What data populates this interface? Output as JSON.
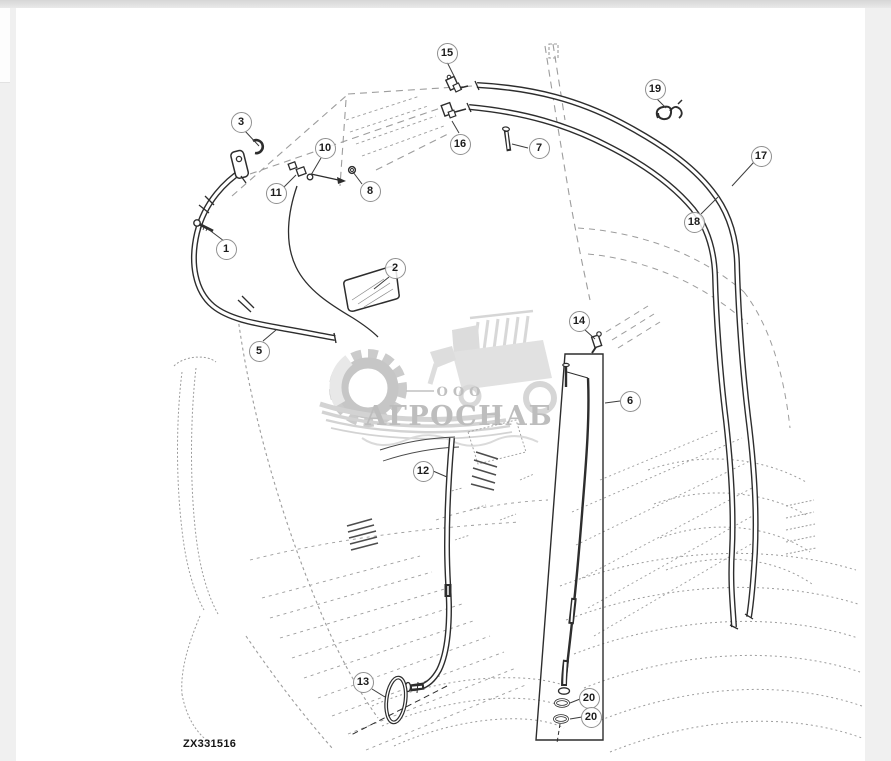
{
  "window": {
    "background_color": "#f0f0f0",
    "topbar_color": "#e2e2e2",
    "panel_color": "#ffffff"
  },
  "diagram": {
    "image_code": "ZX331516",
    "line_color": "#2d2d2d",
    "faint_color": "#9d9d9d",
    "callouts": [
      {
        "label": "1",
        "x": 226,
        "y": 249
      },
      {
        "label": "2",
        "x": 395,
        "y": 268
      },
      {
        "label": "3",
        "x": 241,
        "y": 122
      },
      {
        "label": "5",
        "x": 259,
        "y": 351
      },
      {
        "label": "6",
        "x": 630,
        "y": 401
      },
      {
        "label": "7",
        "x": 539,
        "y": 148
      },
      {
        "label": "8",
        "x": 370,
        "y": 191
      },
      {
        "label": "10",
        "x": 325,
        "y": 148
      },
      {
        "label": "11",
        "x": 276,
        "y": 193
      },
      {
        "label": "12",
        "x": 423,
        "y": 471
      },
      {
        "label": "13",
        "x": 363,
        "y": 682
      },
      {
        "label": "14",
        "x": 579,
        "y": 321
      },
      {
        "label": "15",
        "x": 447,
        "y": 53
      },
      {
        "label": "16",
        "x": 460,
        "y": 144
      },
      {
        "label": "17",
        "x": 761,
        "y": 156
      },
      {
        "label": "18",
        "x": 694,
        "y": 222
      },
      {
        "label": "19",
        "x": 655,
        "y": 89
      },
      {
        "label": "20",
        "x": 589,
        "y": 698
      },
      {
        "label": "20",
        "x": 591,
        "y": 717
      }
    ]
  },
  "watermark": {
    "prefix": "ООО",
    "name": "АГРОСНАБ",
    "color": "#b4b4b4"
  }
}
